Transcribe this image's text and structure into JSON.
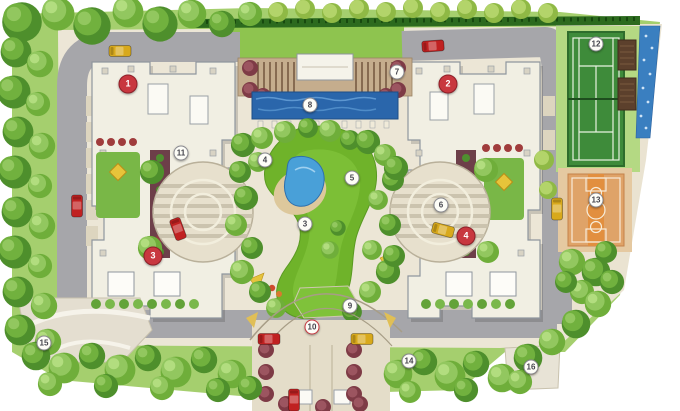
{
  "plan": {
    "type": "architectural-residential-masterplan-site-plan",
    "palette": {
      "background": "#ffffff",
      "tree_dark": "#4e8f2c",
      "tree_mid": "#71b13e",
      "tree_light": "#92c75f",
      "tree_maroon": "#7e3b46",
      "grass_base": "#a5cf6e",
      "lawn_bright": "#8ec44f",
      "park_lawn": "#6fb32a",
      "road_gray": "#a6a6aa",
      "paving_tan": "#ece6d6",
      "building_cream": "#f1efe3",
      "building_outline": "#8f969e",
      "pool_water": "#2a66ab",
      "pond_water": "#49a0d8",
      "cascade_water": "#3a7fc0",
      "deck_brown": "#c5ad8d",
      "pergola_brown": "#5c402c",
      "tennis_green": "#3e8b3a",
      "basketball_orange": "#dfa368",
      "sand": "#ddc89c",
      "marker_red": "#c8373f",
      "marker_white": "#fdfdf7",
      "car_red": "#c02121",
      "car_yellow": "#d8a91c"
    },
    "markers": {
      "building": [
        {
          "label": "1",
          "name": "tower-1"
        },
        {
          "label": "2",
          "name": "tower-2"
        },
        {
          "label": "3",
          "name": "tower-3"
        },
        {
          "label": "4",
          "name": "tower-4"
        }
      ],
      "amenity": [
        {
          "label": "3",
          "name": "central-lawn"
        },
        {
          "label": "4",
          "name": "pond-grove"
        },
        {
          "label": "5",
          "name": "east-lawn"
        },
        {
          "label": "6",
          "name": "east-plaza"
        },
        {
          "label": "7",
          "name": "clubhouse-pavilion"
        },
        {
          "label": "8",
          "name": "reflecting-pool"
        },
        {
          "label": "9",
          "name": "entry-lawn"
        },
        {
          "label": "10",
          "name": "entry-court"
        },
        {
          "label": "11",
          "name": "west-plaza"
        },
        {
          "label": "12",
          "name": "tennis-court"
        },
        {
          "label": "13",
          "name": "basketball-court"
        },
        {
          "label": "14",
          "name": "east-tree-walk"
        },
        {
          "label": "15",
          "name": "southwest-plaza"
        },
        {
          "label": "16",
          "name": "southeast-seating-court"
        }
      ]
    },
    "vehicles": [
      {
        "color": "#d8a91c",
        "area": "north-road-west"
      },
      {
        "color": "#c02121",
        "area": "north-road-east"
      },
      {
        "color": "#c02121",
        "area": "west-road"
      },
      {
        "color": "#c02121",
        "area": "west-plaza"
      },
      {
        "color": "#d8a91c",
        "area": "east-road"
      },
      {
        "color": "#d8a91c",
        "area": "east-plaza"
      },
      {
        "color": "#c02121",
        "area": "entry-court-west"
      },
      {
        "color": "#d8a91c",
        "area": "entry-court-east"
      },
      {
        "color": "#c02121",
        "area": "entrance-drive"
      }
    ]
  }
}
